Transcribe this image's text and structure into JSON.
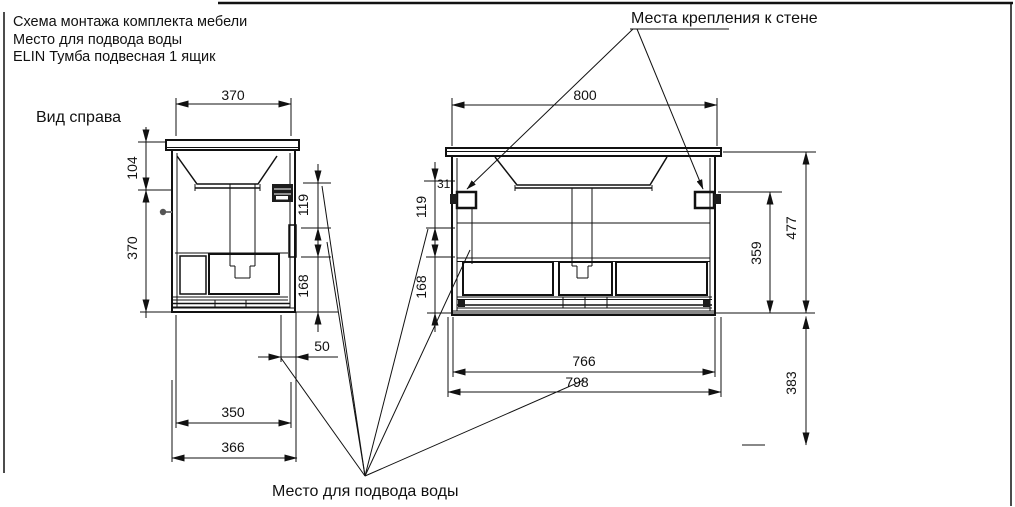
{
  "title_block": {
    "line1": "Схема монтажа комплекта мебели",
    "line2": "Место для подвода воды",
    "line3": "ELIN Тумба подвесная 1 ящик"
  },
  "annotations": {
    "wall_mount": "Места крепления к стене",
    "water_supply": "Место для подвода воды",
    "side_view_label": "Вид справа"
  },
  "side_view": {
    "dims": {
      "top_width": "370",
      "height_top": "104",
      "height_main": "370",
      "offset_bracket": "119",
      "offset_opening": "168",
      "water_offset": "50",
      "width_inner": "350",
      "width_outer": "366"
    }
  },
  "front_view": {
    "dims": {
      "top_width": "800",
      "top_gap": "31",
      "offset_bracket": "119",
      "offset_opening": "168",
      "bracket_height": "359",
      "total_height": "477",
      "bottom_clearance": "383",
      "width_inner": "766",
      "width_outer": "798"
    }
  }
}
